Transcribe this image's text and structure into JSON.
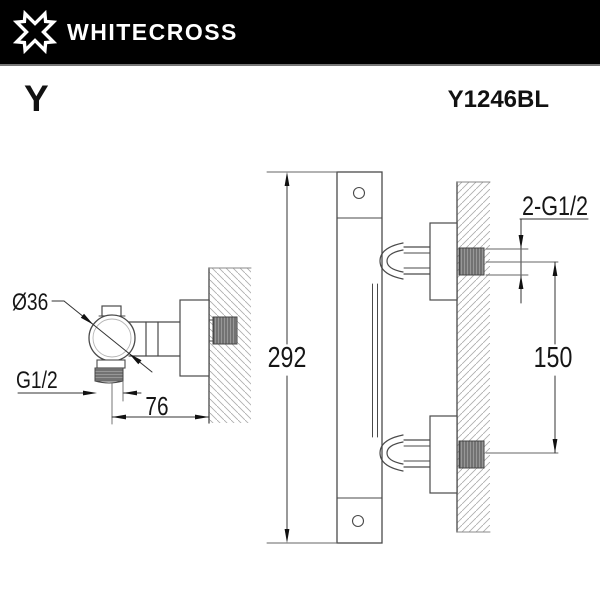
{
  "header": {
    "brand": "WHITECROSS",
    "logo_icon": "whitecross-x-logo",
    "bg_color": "#000000",
    "text_color": "#ffffff"
  },
  "page": {
    "series_label": "Y",
    "model_code": "Y1246BL"
  },
  "left_view": {
    "description": "side view of wall-mounted shower outlet elbow",
    "labels": {
      "diameter": "Ø36",
      "thread": "G1/2",
      "depth": "76"
    }
  },
  "right_view": {
    "description": "side view of thermostatic shower bar with two wall unions",
    "labels": {
      "height": "292",
      "thread": "2-G1/2",
      "spacing": "150"
    }
  }
}
